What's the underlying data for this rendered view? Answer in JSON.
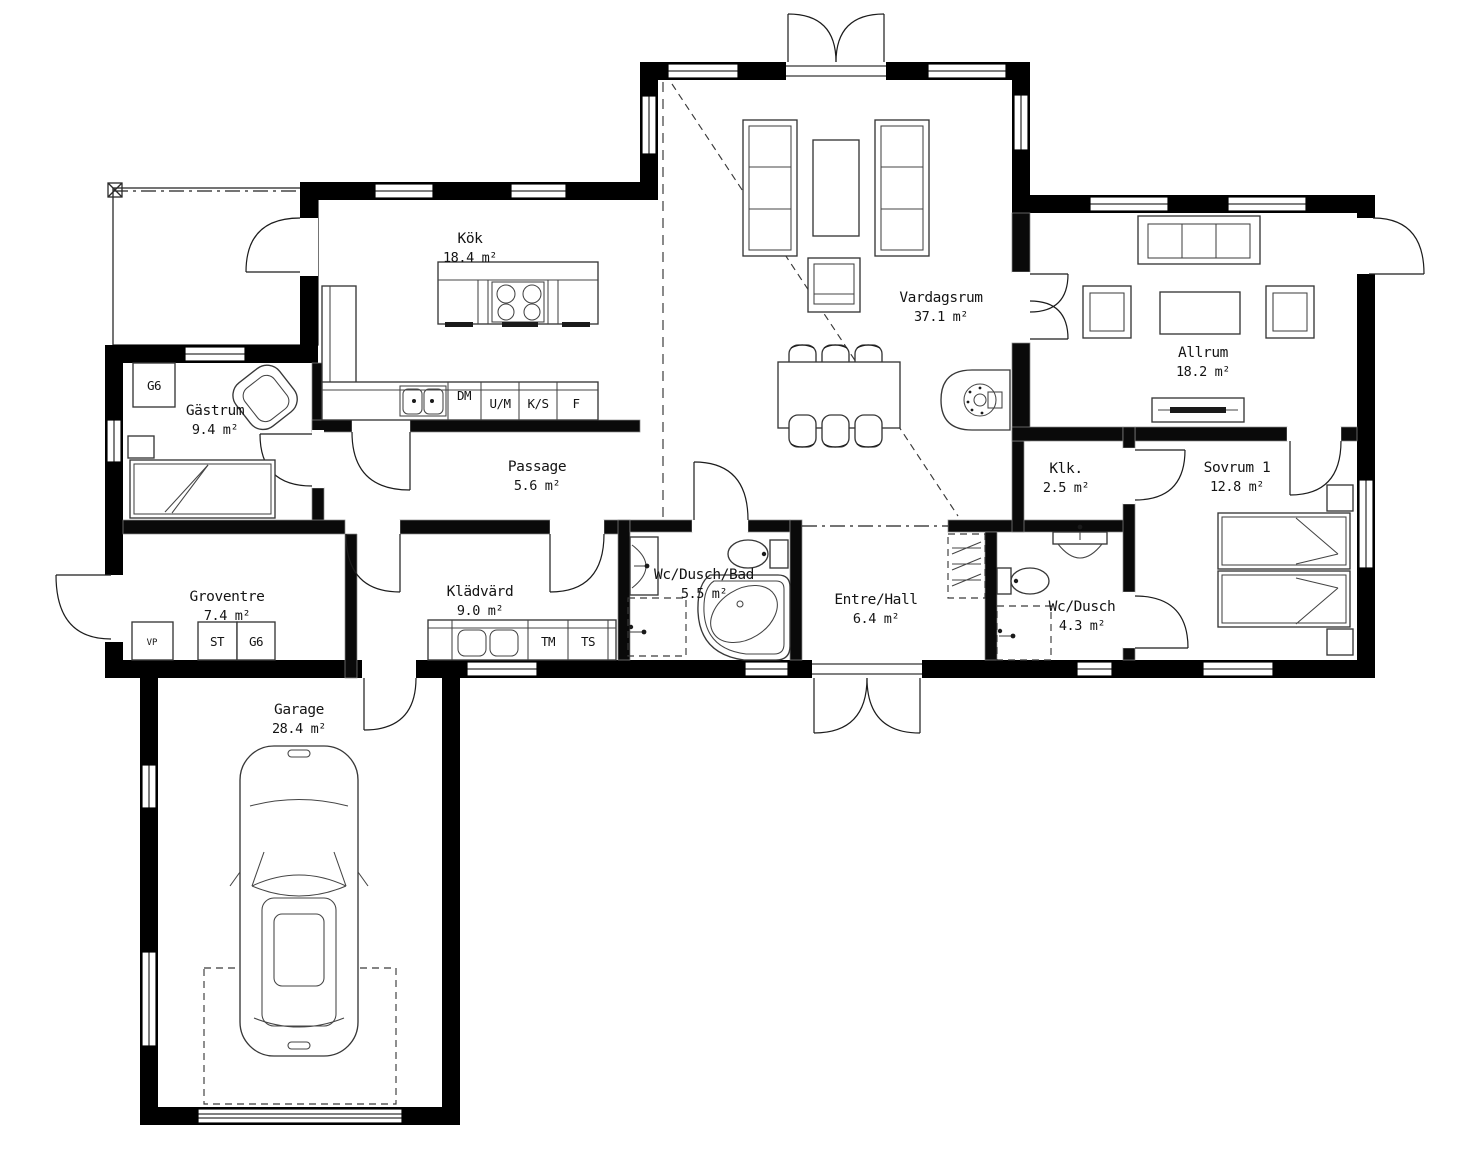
{
  "drawing": {
    "type": "floor-plan",
    "background": "#ffffff",
    "wall_color": "#000000",
    "line_color": "#2a2a2a"
  },
  "rooms": [
    {
      "id": "kok",
      "name": "Kök",
      "area": "18.4 m²"
    },
    {
      "id": "gastrum",
      "name": "Gästrum",
      "area": "9.4 m²"
    },
    {
      "id": "passage",
      "name": "Passage",
      "area": "5.6 m²"
    },
    {
      "id": "vardagsrum",
      "name": "Vardagsrum",
      "area": "37.1 m²"
    },
    {
      "id": "allrum",
      "name": "Allrum",
      "area": "18.2 m²"
    },
    {
      "id": "klk",
      "name": "Klk.",
      "area": "2.5 m²"
    },
    {
      "id": "sovrum1",
      "name": "Sovrum 1",
      "area": "12.8 m²"
    },
    {
      "id": "groventre",
      "name": "Groventre",
      "area": "7.4 m²"
    },
    {
      "id": "kladvard",
      "name": "Klädvärd",
      "area": "9.0 m²"
    },
    {
      "id": "wcduschbad",
      "name": "Wc/Dusch/Bad",
      "area": "5.5 m²"
    },
    {
      "id": "entrehall",
      "name": "Entre/Hall",
      "area": "6.4 m²"
    },
    {
      "id": "wcdusch",
      "name": "Wc/Dusch",
      "area": "4.3 m²"
    },
    {
      "id": "garage",
      "name": "Garage",
      "area": "28.4 m²"
    }
  ],
  "fixtures": {
    "g6_gastrum": "G6",
    "dm": "DM",
    "um": "U/M",
    "ks": "K/S",
    "f": "F",
    "vp": "VP",
    "st": "ST",
    "g6_groventre": "G6",
    "tm": "TM",
    "ts": "TS"
  }
}
